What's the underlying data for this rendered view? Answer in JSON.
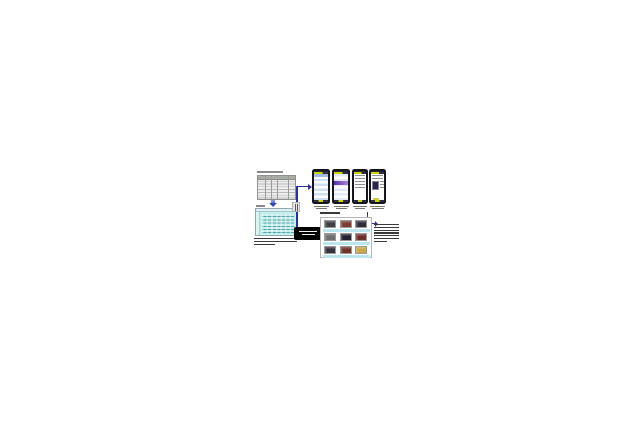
{
  "meta": {
    "canvas_width": 640,
    "canvas_height": 426,
    "background": "#ffffff"
  },
  "colors": {
    "connector_navy": "#2e3192",
    "flow_arrow_blue": "#3a47ad",
    "pc_window_body": "#c6efec",
    "pc_window_scribble": "#3a96a0",
    "server_box_bg": "#000000",
    "server_box_text": "#f2f2f2",
    "phone_frame": "#15151d",
    "phone_nav_yellow": "#c9d400",
    "phone_list_blue": "#cfe0f4",
    "phone_band_purple": "#5a2ba8",
    "album_strip_blue": "#b9e6ef",
    "table_header_gray": "#a9aea4",
    "caption_ink": "#3a3a3a"
  },
  "data_table": {
    "columns": 5,
    "body_rows": 8,
    "header_rows": 1,
    "title_lines": 1
  },
  "pc_window": {
    "label_lines": 1,
    "scribble_text_lines": 7,
    "caption_lines": 3
  },
  "server_box": {
    "text_lines": 2
  },
  "phones": [
    {
      "id": "phone-1",
      "screen_type": "blue-list",
      "caption_lines": 2
    },
    {
      "id": "phone-2",
      "screen_type": "list-with-purple-banner",
      "caption_lines": 2
    },
    {
      "id": "phone-3",
      "screen_type": "text-page",
      "caption_lines": 2
    },
    {
      "id": "phone-4",
      "screen_type": "photo-detail-page",
      "caption_lines": 2
    }
  ],
  "album_grid": {
    "caption_lines": 1,
    "strip_color": "#b9e6ef",
    "rows": [
      {
        "thumbs": [
          "#3f3f46",
          "#7a3a30",
          "#2e2e38"
        ]
      },
      {
        "thumbs": [
          "#6f6f6f",
          "#262030",
          "#6e2e28"
        ]
      },
      {
        "thumbs": [
          "#34343e",
          "#6e3428",
          "#c8a84a"
        ]
      }
    ]
  },
  "note_block": {
    "lines": 7
  },
  "smudges": {
    "table_title": {
      "h": 1.5,
      "gap": 0,
      "color": "#8a8a8a",
      "widths": [
        26
      ]
    },
    "window_label": {
      "h": 1.5,
      "gap": 0,
      "color": "#8a8a8a",
      "widths": [
        9
      ]
    },
    "window_caption": {
      "h": 1.4,
      "gap": 1.5,
      "color": "#3a3a3a",
      "widths": [
        43,
        43,
        21
      ]
    },
    "server_text": {
      "h": 1.4,
      "gap": 1.8,
      "color": "#f2f2f2",
      "widths": [
        18,
        13
      ]
    },
    "caption_phone1": {
      "h": 1.2,
      "gap": 1.4,
      "color": "#777777",
      "widths": [
        15,
        11
      ]
    },
    "caption_phone2": {
      "h": 1.2,
      "gap": 1.4,
      "color": "#777777",
      "widths": [
        15,
        11
      ]
    },
    "caption_phone3": {
      "h": 1.2,
      "gap": 1.4,
      "color": "#777777",
      "widths": [
        14,
        10
      ]
    },
    "caption_phone4": {
      "h": 1.2,
      "gap": 1.4,
      "color": "#777777",
      "widths": [
        15,
        12
      ]
    },
    "grid_caption": {
      "h": 1.7,
      "gap": 0,
      "color": "#3a3a3a",
      "widths": [
        20
      ]
    },
    "note_text": {
      "h": 1.3,
      "gap": 1.5,
      "color": "#3a3a3a",
      "widths": [
        25,
        25,
        25,
        25,
        25,
        25,
        13
      ]
    }
  }
}
